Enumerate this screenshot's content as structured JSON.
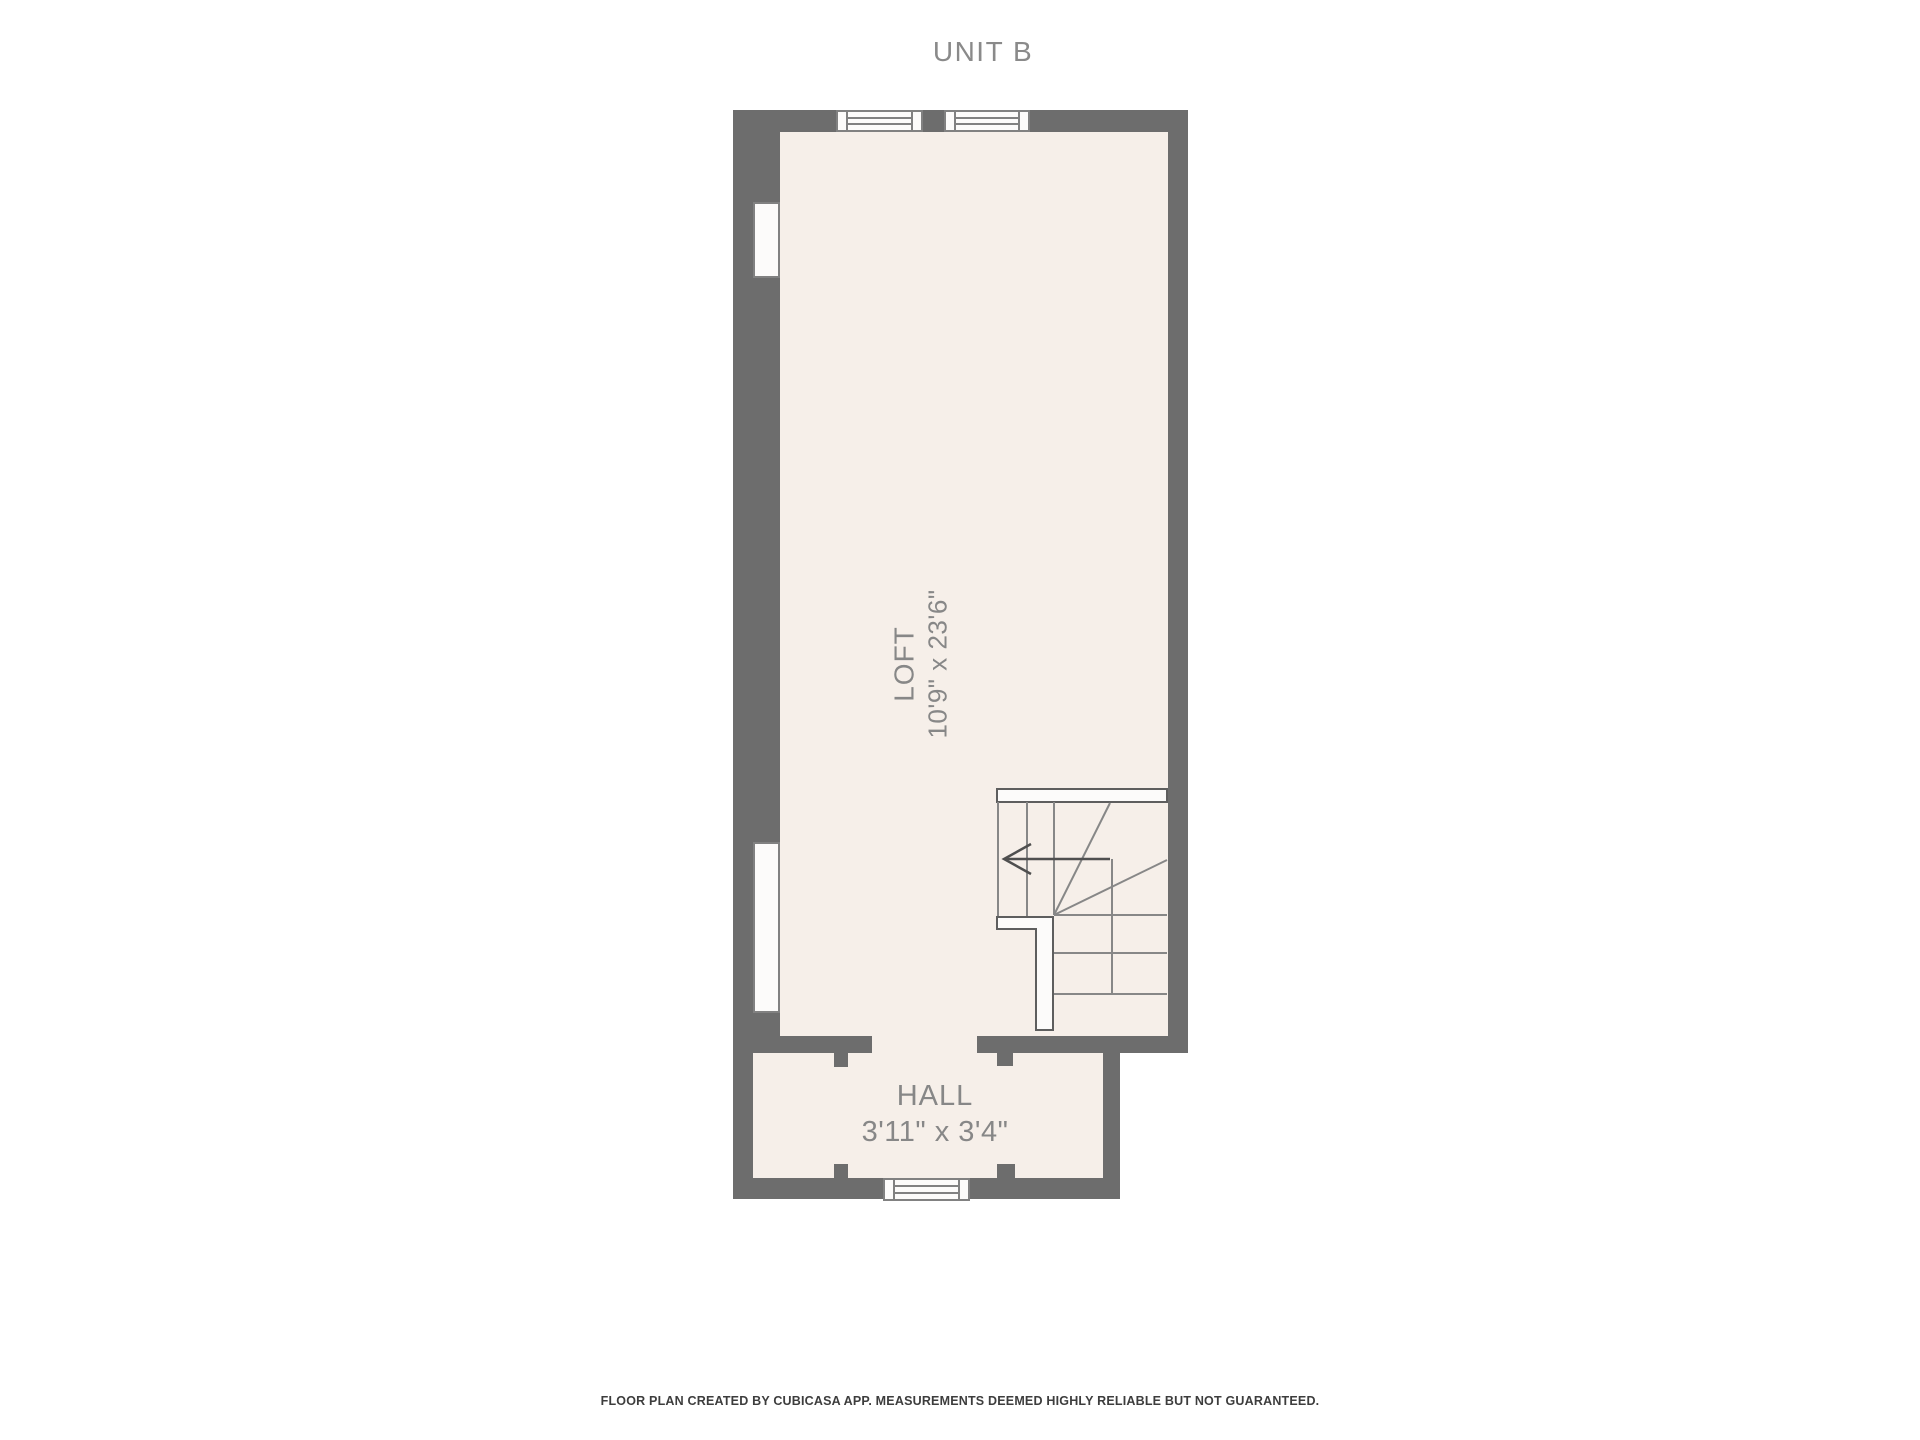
{
  "title": "UNIT B",
  "rooms": {
    "loft": {
      "name": "LOFT",
      "dimensions": "10'9\" x 23'6\""
    },
    "hall": {
      "name": "HALL",
      "dimensions": "3'11\" x 3'4\""
    }
  },
  "footer": "FLOOR PLAN CREATED BY CUBICASA APP. MEASUREMENTS DEEMED HIGHLY RELIABLE BUT NOT GUARANTEED.",
  "colors": {
    "wall": "#6d6d6d",
    "floor": "#f6efe9",
    "window": "#fcfbfa",
    "frame": "#818181",
    "room-text": "#878787",
    "title-text": "#8a8a8a",
    "footer-text": "#3d3d3d",
    "stair-line": "#878787",
    "stair-outline": "#5e5e5e",
    "arrow": "#4f4f4f"
  }
}
